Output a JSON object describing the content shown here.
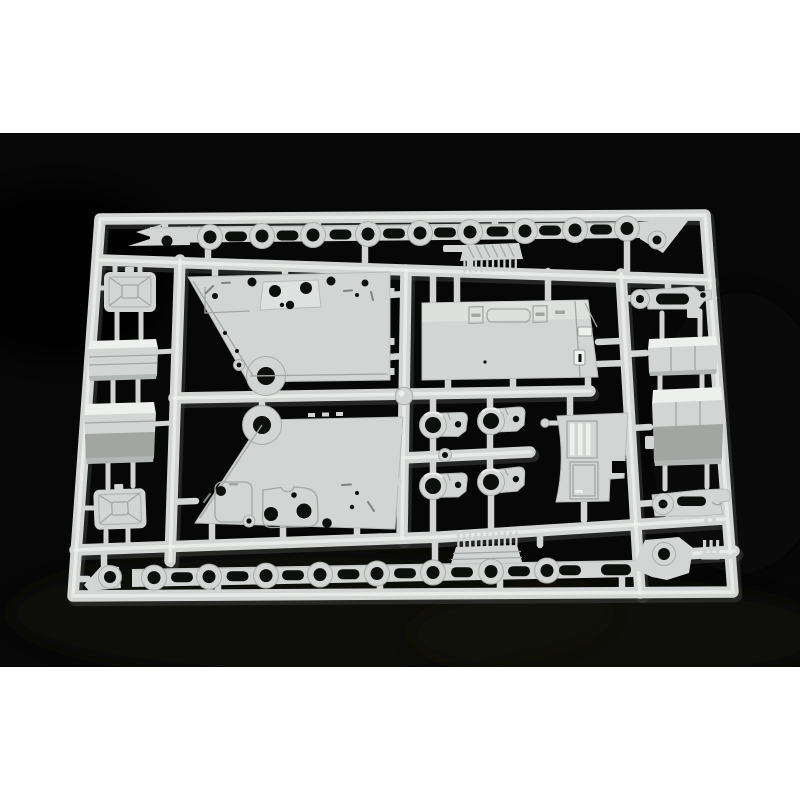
{
  "meta": {
    "kind": "product-photograph",
    "subject": "injection-molded plastic model kit sprue (parts tree) of light grey styrene, photographed on a black background",
    "layout": "landscape photo centered with white margins above and below",
    "text_content": "none (no text visible in image)"
  },
  "photo": {
    "width_px": 800,
    "height_px": 534,
    "top_margin_px": 133,
    "bottom_margin_px": 133
  },
  "colors": {
    "paper": "#ffffff",
    "background": "#070707",
    "mottle": "#191711",
    "plastic_base": "#d2d5d3",
    "plastic_highlight": "#eef0ee",
    "plastic_shadow": "#3f423f",
    "plastic_dark": "#a2a5a2",
    "hole": "#0d0f0d"
  },
  "sprue": {
    "frame": "rectangular runner frame with rounded corners, slight perspective (wider at bottom)",
    "runner_count": 9,
    "injection_node": "round ball node at center where runners cross",
    "parts": [
      {
        "name": "top-fender-part",
        "desc": "long track-guard strip with 9 ring bosses and 8 oval slots, arrow-shaped left tip, angled right wing with boss"
      },
      {
        "name": "top-grille-comb",
        "desc": "small ribbed plate with 10 downward teeth under top fender"
      },
      {
        "name": "upper-hull-plate",
        "desc": "large trapezoidal hull side plate, diagonal left edge, round boss with hole at bottom, surface details and holes"
      },
      {
        "name": "lower-hull-plate",
        "desc": "mirrored trapezoidal hull side plate, round boss with hole at top-left, bracket detail with two holes"
      },
      {
        "name": "engine-deck-plate",
        "desc": "large rectangular deck plate with two latch clamps, recessed panel and side handles"
      },
      {
        "name": "curved-grille-plate",
        "desc": "curved plate with two recessed louver panels and side notch"
      },
      {
        "name": "mg-part",
        "desc": "elongated fitting with ring eye, oval slot and forked end (top right)"
      },
      {
        "name": "lever-part",
        "desc": "elongated fitting with ring eye and oval slot (bottom right)"
      },
      {
        "name": "stowage-box-1",
        "desc": "small lidded stowage box (right column)"
      },
      {
        "name": "stowage-box-2",
        "desc": "large two-tone stowage box with grey lower face (right column)"
      },
      {
        "name": "jerry-can-1",
        "desc": "X-ribbed canister (upper left column)"
      },
      {
        "name": "jerry-can-2",
        "desc": "X-ribbed canister (lower left column)"
      },
      {
        "name": "fuel-tank-1",
        "desc": "small slab-sided tank box (left column)"
      },
      {
        "name": "fuel-tank-2",
        "desc": "large two-tone tank box with grey lower face (left column)"
      },
      {
        "name": "axle-hub-1",
        "desc": "ring hub with bracket arm, row 1 left"
      },
      {
        "name": "axle-hub-2",
        "desc": "ring hub with bracket arm, row 1 right"
      },
      {
        "name": "axle-hub-3",
        "desc": "ring hub with bracket arm, row 2 left"
      },
      {
        "name": "axle-hub-4",
        "desc": "ring hub with bracket arm, row 2 right"
      },
      {
        "name": "hub-circlet",
        "desc": "small ring collar on middle mini-runner"
      },
      {
        "name": "bottom-grille-comb",
        "desc": "ribbed plate with 10 upward teeth above bottom fender"
      },
      {
        "name": "bottom-fender-part",
        "desc": "long track-guard strip with 8 ring bosses and oval slots, boss wing at right end"
      },
      {
        "name": "corner-bracket-part",
        "desc": "small wedge bracket with ring eye (bottom left)"
      },
      {
        "name": "trident-part",
        "desc": "small three-prong fork fitting (bottom right)"
      },
      {
        "name": "pin-part",
        "desc": "tiny pin beside curved grille plate"
      }
    ],
    "counts": {
      "top_fender_rings": 9,
      "top_fender_slots": 8,
      "bottom_fender_rings": 8,
      "bottom_fender_slots": 9,
      "comb_teeth_each": 10,
      "axle_hubs": 4
    }
  }
}
